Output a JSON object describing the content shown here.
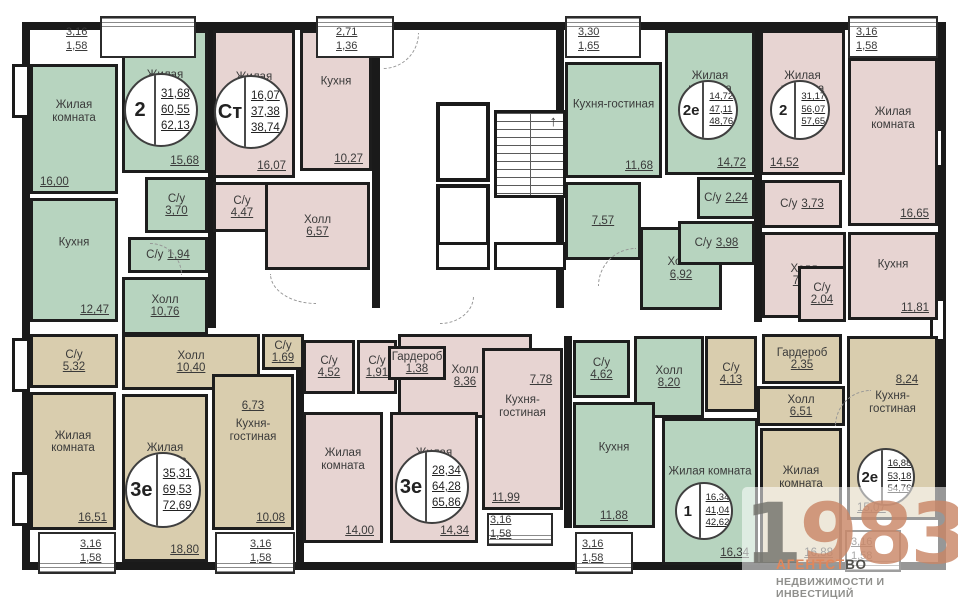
{
  "colors": {
    "green": "#b7d4bf",
    "pink": "#e7d4d2",
    "beige": "#d9cdae",
    "wall": "#1a1a1a",
    "label": "#3a3a3a",
    "watermark_gray": "#76766e",
    "watermark_accent": "#c98667",
    "agency_orange": "#e0875c",
    "agency_gray": "#8f8f8c"
  },
  "watermark": {
    "year_gray": "1",
    "year_accent": "983",
    "agency_part1": "АГЕНТСТ",
    "agency_part2": "ВО",
    "agency_line2": "НЕДВИЖИМОСТИ И ИНВЕСТИЦИЙ"
  },
  "plan": {
    "width": 958,
    "height": 600,
    "building": [
      22,
      22,
      924,
      548
    ],
    "apartments": [
      {
        "id": "apt-2-top-left",
        "color": "green",
        "badge": {
          "type": "2",
          "values": [
            "31,68",
            "60,55",
            "62,13"
          ],
          "cx": 161,
          "cy": 110,
          "r": 37
        },
        "rooms": [
          {
            "label": "Жилая комната",
            "value": "16,00",
            "box": [
              30,
              64,
              88,
              130
            ],
            "vpos": "bl"
          },
          {
            "label": "Кухня",
            "value": "12,47",
            "box": [
              30,
              198,
              88,
              124
            ],
            "vpos": "br"
          },
          {
            "label": "Жилая комната",
            "value": "15,68",
            "box": [
              122,
              30,
              86,
              143
            ],
            "vpos": "br"
          },
          {
            "label": "С/у",
            "value": "3,70",
            "box": [
              145,
              177,
              63,
              56
            ],
            "vpos": "stack"
          },
          {
            "label": "С/у",
            "value": "1,94",
            "box": [
              128,
              237,
              80,
              36
            ],
            "vpos": "inline"
          },
          {
            "label": "Холл",
            "value": "10,76",
            "box": [
              122,
              277,
              86,
              58
            ],
            "vpos": "stack"
          }
        ]
      },
      {
        "id": "apt-studio",
        "color": "pink",
        "badge": {
          "type": "Ст",
          "values": [
            "16,07",
            "37,38",
            "38,74"
          ],
          "cx": 251,
          "cy": 112,
          "r": 37
        },
        "rooms": [
          {
            "label": "Жилая комната",
            "value": "16,07",
            "box": [
              213,
              30,
              82,
              148
            ],
            "vpos": "br"
          },
          {
            "label": "Кухня",
            "value": "10,27",
            "box": [
              300,
              30,
              72,
              141
            ],
            "vpos": "br"
          },
          {
            "label": "С/у",
            "value": "4,47",
            "box": [
              213,
              182,
              58,
              50
            ],
            "vpos": "stack"
          },
          {
            "label": "Холл",
            "value": "6,57",
            "box": [
              265,
              182,
              105,
              88
            ],
            "vpos": "stack"
          }
        ]
      },
      {
        "id": "apt-2e-top",
        "color": "green",
        "badge": {
          "type": "2е",
          "values": [
            "14,72",
            "47,11",
            "48,76"
          ],
          "cx": 708,
          "cy": 110,
          "r": 30
        },
        "rooms": [
          {
            "label": "Кухня-гостиная",
            "value": "11,68",
            "box": [
              565,
              62,
              97,
              116
            ],
            "vpos": "br"
          },
          {
            "label": "",
            "value": "7,57",
            "box": [
              565,
              182,
              76,
              78
            ],
            "vpos": "c"
          },
          {
            "label": "Жилая комната",
            "value": "14,72",
            "box": [
              665,
              30,
              90,
              145
            ],
            "vpos": "br"
          },
          {
            "label": "Холл",
            "value": "6,92",
            "box": [
              640,
              227,
              82,
              83
            ],
            "vpos": "stack"
          },
          {
            "label": "С/у",
            "value": "2,24",
            "box": [
              697,
              177,
              58,
              42
            ],
            "vpos": "inline"
          },
          {
            "label": "С/у",
            "value": "3,98",
            "box": [
              678,
              221,
              77,
              44
            ],
            "vpos": "inline"
          }
        ]
      },
      {
        "id": "apt-2-top-right",
        "color": "pink",
        "badge": {
          "type": "2",
          "values": [
            "31,17",
            "56,07",
            "57,65"
          ],
          "cx": 800,
          "cy": 110,
          "r": 30
        },
        "rooms": [
          {
            "label": "Жилая комната",
            "value": "14,52",
            "box": [
              760,
              30,
              85,
              145
            ],
            "vpos": "bl"
          },
          {
            "label": "Жилая комната",
            "value": "16,65",
            "box": [
              848,
              58,
              90,
              168
            ],
            "vpos": "br"
          },
          {
            "label": "Холл",
            "value": "7,32",
            "box": [
              762,
              232,
              84,
              86
            ],
            "vpos": "stack"
          },
          {
            "label": "С/у",
            "value": "3,73",
            "box": [
              762,
              180,
              80,
              48
            ],
            "vpos": "inline"
          },
          {
            "label": "С/у",
            "value": "2,04",
            "box": [
              798,
              266,
              48,
              56
            ],
            "vpos": "stack"
          },
          {
            "label": "Кухня",
            "value": "11,81",
            "box": [
              848,
              232,
              90,
              88
            ],
            "vpos": "br"
          }
        ]
      },
      {
        "id": "apt-3e-bottom-left",
        "color": "beige",
        "badge": {
          "type": "3е",
          "values": [
            "35,31",
            "69,53",
            "72,69"
          ],
          "cx": 163,
          "cy": 490,
          "r": 38
        },
        "rooms": [
          {
            "label": "С/у",
            "value": "5,32",
            "box": [
              30,
              334,
              88,
              54
            ],
            "vpos": "stack"
          },
          {
            "label": "Холл",
            "value": "10,40",
            "box": [
              122,
              334,
              138,
              56
            ],
            "vpos": "stack"
          },
          {
            "label": "С/у",
            "value": "1,69",
            "box": [
              262,
              334,
              42,
              36
            ],
            "vpos": "stack"
          },
          {
            "label": "Жилая комната",
            "value": "16,51",
            "box": [
              30,
              392,
              86,
              138
            ],
            "vpos": "br"
          },
          {
            "label": "Жилая комната",
            "value": "18,80",
            "box": [
              122,
              394,
              86,
              168
            ],
            "vpos": "br"
          },
          {
            "label": "Кухня-гостиная",
            "value": "10,08",
            "box": [
              212,
              374,
              82,
              156
            ],
            "vpos": "br"
          },
          {
            "label": "",
            "value": "6,73",
            "box": [
              216,
              396,
              74,
              20
            ],
            "vpos": "plain"
          }
        ]
      },
      {
        "id": "apt-3e-bottom-mid",
        "color": "pink",
        "badge": {
          "type": "3е",
          "values": [
            "28,34",
            "64,28",
            "65,86"
          ],
          "cx": 432,
          "cy": 487,
          "r": 37
        },
        "rooms": [
          {
            "label": "Холл",
            "value": "8,36",
            "box": [
              398,
              334,
              134,
              84
            ],
            "vpos": "stack"
          },
          {
            "label": "С/у",
            "value": "4,52",
            "box": [
              303,
              340,
              52,
              54
            ],
            "vpos": "stack"
          },
          {
            "label": "С/у",
            "value": "1,91",
            "box": [
              357,
              340,
              40,
              54
            ],
            "vpos": "stack"
          },
          {
            "label": "Гардероб",
            "value": "1,38",
            "box": [
              388,
              346,
              58,
              34
            ],
            "vpos": "stack"
          },
          {
            "label": "Жилая комната",
            "value": "14,00",
            "box": [
              303,
              412,
              80,
              131
            ],
            "vpos": "br"
          },
          {
            "label": "Жилая комната",
            "value": "14,34",
            "box": [
              390,
              412,
              88,
              131
            ],
            "vpos": "br"
          },
          {
            "label": "Кухня-гостиная",
            "value": "11,99",
            "box": [
              482,
              348,
              81,
              162
            ],
            "vpos": "bl"
          },
          {
            "label": "",
            "value": "7,78",
            "box": [
              518,
              370,
              46,
              20
            ],
            "vpos": "plain"
          }
        ]
      },
      {
        "id": "apt-1-bottom",
        "color": "green",
        "badge": {
          "type": "1",
          "values": [
            "16,34",
            "41,04",
            "42,62"
          ],
          "cx": 704,
          "cy": 511,
          "r": 29
        },
        "rooms": [
          {
            "label": "С/у",
            "value": "4,62",
            "box": [
              573,
              340,
              57,
              58
            ],
            "vpos": "stack"
          },
          {
            "label": "Холл",
            "value": "8,20",
            "box": [
              634,
              336,
              70,
              82
            ],
            "vpos": "stack"
          },
          {
            "label": "Кухня",
            "value": "11,88",
            "box": [
              573,
              402,
              82,
              126
            ],
            "vpos": "bc"
          },
          {
            "label": "Жилая комната",
            "value": "16,34",
            "box": [
              662,
              418,
              96,
              147
            ],
            "vpos": "br"
          }
        ]
      },
      {
        "id": "apt-2e-bottom-right",
        "color": "beige",
        "badge": {
          "type": "2е",
          "values": [
            "16,88",
            "53,18",
            "54,76"
          ],
          "cx": 886,
          "cy": 477,
          "r": 29
        },
        "rooms": [
          {
            "label": "С/у",
            "value": "4,13",
            "box": [
              705,
              336,
              52,
              76
            ],
            "vpos": "stack"
          },
          {
            "label": "Гардероб",
            "value": "2,35",
            "box": [
              762,
              334,
              80,
              50
            ],
            "vpos": "stack"
          },
          {
            "label": "Холл",
            "value": "6,51",
            "box": [
              757,
              386,
              88,
              40
            ],
            "vpos": "stack"
          },
          {
            "label": "Жилая комната",
            "value": "16,88",
            "box": [
              760,
              428,
              82,
              137
            ],
            "vpos": "br"
          },
          {
            "label": "Кухня-гостиная",
            "value": "15,07",
            "box": [
              847,
              336,
              91,
              184
            ],
            "vpos": "bl"
          },
          {
            "label": "",
            "value": "8,24",
            "box": [
              878,
              370,
              58,
              20
            ],
            "vpos": "plain"
          }
        ]
      }
    ],
    "balconies": [
      {
        "values": [
          "3,16",
          "1,58"
        ],
        "box": [
          100,
          16,
          96,
          42
        ],
        "rail": "top",
        "label": [
          66,
          26
        ]
      },
      {
        "values": [
          "2,71",
          "1,36"
        ],
        "box": [
          316,
          16,
          78,
          42
        ],
        "rail": "top",
        "label": [
          336,
          26
        ]
      },
      {
        "values": [
          "3,30",
          "1,65"
        ],
        "box": [
          565,
          16,
          76,
          42
        ],
        "rail": "top",
        "label": [
          578,
          26
        ]
      },
      {
        "values": [
          "3,16",
          "1,58"
        ],
        "box": [
          848,
          16,
          90,
          42
        ],
        "rail": "top",
        "label": [
          856,
          26
        ]
      },
      {
        "values": [
          "3,16",
          "1,58"
        ],
        "box": [
          38,
          532,
          78,
          42
        ],
        "rail": "bottom",
        "label": [
          80,
          538
        ]
      },
      {
        "values": [
          "3,16",
          "1,58"
        ],
        "box": [
          215,
          532,
          80,
          42
        ],
        "rail": "bottom",
        "label": [
          250,
          538
        ]
      },
      {
        "values": [
          "3,16",
          "1,58"
        ],
        "box": [
          487,
          513,
          66,
          33
        ],
        "rail": "bottom",
        "label": [
          490,
          514
        ]
      },
      {
        "values": [
          "3,16",
          "1,58"
        ],
        "box": [
          575,
          532,
          58,
          42
        ],
        "rail": "bottom",
        "label": [
          582,
          538
        ]
      },
      {
        "values": [
          "3,16",
          "1,58"
        ],
        "box": [
          845,
          530,
          56,
          42
        ],
        "rail": "bottom",
        "label": [
          851,
          536
        ]
      }
    ],
    "core": {
      "elevators": [
        [
          436,
          102,
          54,
          80
        ],
        [
          436,
          184,
          54,
          76
        ]
      ],
      "stairs": [
        494,
        110,
        72,
        88
      ],
      "stairs_arrow": "↑",
      "ducts": [
        [
          436,
          242,
          54,
          28
        ],
        [
          494,
          242,
          72,
          28
        ]
      ]
    },
    "walls": [
      [
        208,
        30,
        8,
        298
      ],
      [
        372,
        30,
        8,
        278
      ],
      [
        556,
        30,
        8,
        278
      ],
      [
        754,
        30,
        8,
        292
      ],
      [
        296,
        336,
        8,
        226
      ],
      [
        564,
        336,
        8,
        192
      ]
    ],
    "stubs": [
      [
        12,
        64,
        18,
        54
      ],
      [
        12,
        338,
        18,
        54
      ],
      [
        12,
        472,
        18,
        54
      ],
      [
        928,
        128,
        16,
        40
      ],
      [
        930,
        298,
        16,
        44
      ]
    ],
    "arcs": [
      {
        "box": [
          383,
          33,
          36,
          36
        ],
        "corner": "br"
      },
      {
        "box": [
          598,
          248,
          38,
          38
        ],
        "corner": "tl"
      },
      {
        "box": [
          270,
          274,
          46,
          30
        ],
        "corner": "bl"
      },
      {
        "box": [
          440,
          296,
          34,
          28
        ],
        "corner": "br"
      },
      {
        "box": [
          150,
          243,
          32,
          32
        ],
        "corner": "tr"
      },
      {
        "box": [
          835,
          390,
          36,
          36
        ],
        "corner": "tl"
      }
    ]
  }
}
